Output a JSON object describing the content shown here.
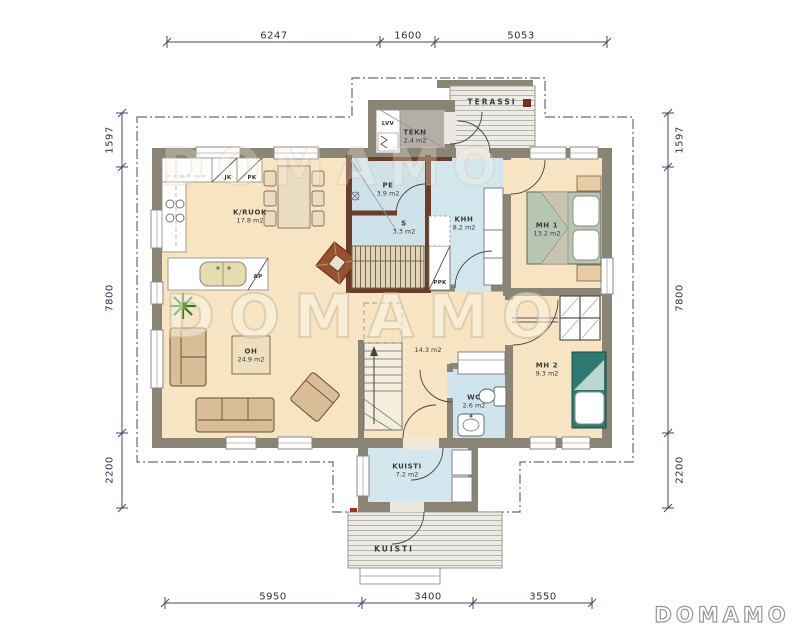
{
  "watermark": {
    "center": "DOMAMO",
    "top": "DOMAMO",
    "logo": "DOMAMO"
  },
  "dimensions": {
    "top": [
      "6247",
      "1600",
      "5053"
    ],
    "bottom": [
      "5950",
      "3400",
      "3550"
    ],
    "left": [
      "1597",
      "7800",
      "2200"
    ],
    "right": [
      "1597",
      "7800",
      "2200"
    ]
  },
  "rooms": [
    {
      "name": "TERASSI",
      "area": ""
    },
    {
      "name": "TEKN",
      "area": "2.4 m2"
    },
    {
      "name": "PE",
      "area": "3.9 m2"
    },
    {
      "name": "S",
      "area": "3.3 m2"
    },
    {
      "name": "KHH",
      "area": "8.2 m2"
    },
    {
      "name": "MH 1",
      "area": "13.2 m2"
    },
    {
      "name": "K/RUOK",
      "area": "17.8 m2"
    },
    {
      "name": "OH",
      "area": "24.9 m2"
    },
    {
      "name": "ET",
      "area": "14.3 m2"
    },
    {
      "name": "WC",
      "area": "2.6 m2"
    },
    {
      "name": "MH 2",
      "area": "9.3 m2"
    },
    {
      "name": "KUISTI",
      "area": "7.2 m2"
    },
    {
      "name": "KUISTI",
      "area": ""
    }
  ],
  "appliances": {
    "jk": "JK",
    "pk": "PK",
    "ap": "AP",
    "lvv": "LVV",
    "ppk": "PPK"
  },
  "colors": {
    "wall": "#8a8474",
    "sauna_wall": "#6b3c28",
    "floor_main": "#f6e4c2",
    "floor_wet": "#cfe2ea",
    "floor_tech": "#b3afa6",
    "accent_red": "#7a3020",
    "dimension_line": "#3d4a66"
  }
}
